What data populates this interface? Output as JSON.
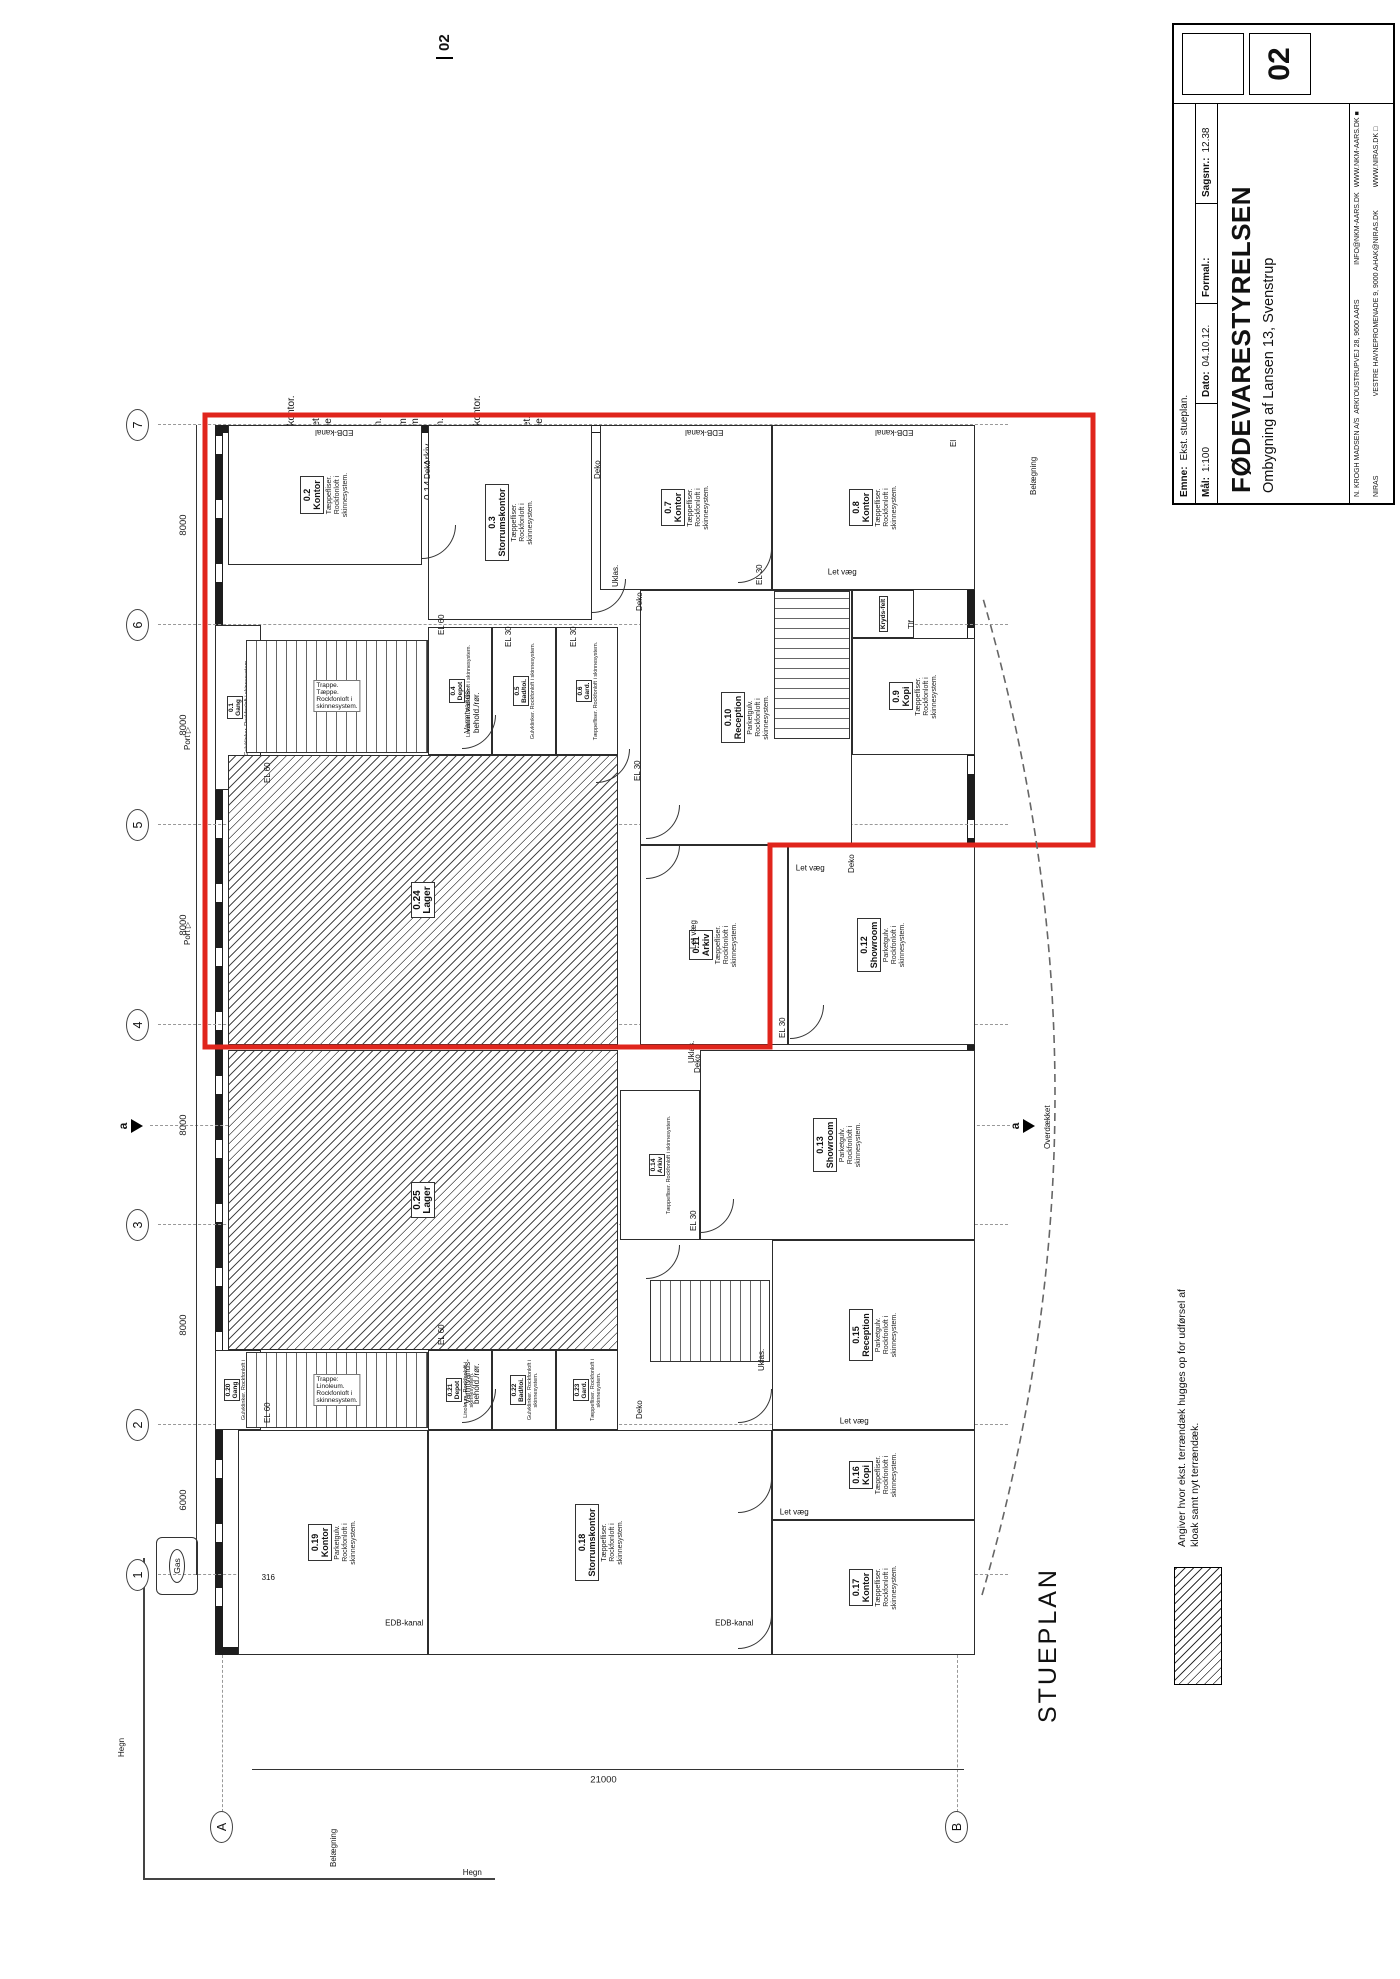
{
  "page": {
    "bg": "#ffffff",
    "accent_red": "#e0251c",
    "sheet_no_top": "02"
  },
  "title_block": {
    "client": "FØDEVARESTYRELSEN",
    "project": "Ombygning af Lansen 13, Svenstrup",
    "emne_label": "Emne:",
    "emne": "Ekst. stueplan.",
    "maal_label": "Mål:",
    "maal": "1:100",
    "dato_label": "Dato:",
    "dato": "04.10.12.",
    "format_label": "Formal.:",
    "format": "",
    "sagsnr_label": "Sagsnr.:",
    "sagsnr": "12.38",
    "drawing_no": "02",
    "firm1_name": "N. KROGH MADSEN A/S",
    "firm1_role": "ARKITEKTER MAA",
    "firm1_addr": "OUSTRUPVEJ 28, 9600 AARS",
    "firm1_email": "INFO@NKM-AARS.DK",
    "firm1_web": "WWW.NKM-AARS.DK",
    "firm1_mark": "■",
    "firm2_name": "NIRAS",
    "firm2_addr": "VESTRE HAVNEPROMENADE 9, 9000 AALBORG",
    "firm2_email": "HAK@NIRAS.DK",
    "firm2_web": "WWW.NIRAS.DK",
    "firm2_mark": "□"
  },
  "room_list": {
    "title": "Rumoversigt:",
    "items": [
      {
        "no": "0.1.",
        "name": "Gang."
      },
      {
        "no": "0.2.",
        "name": "Kontor."
      },
      {
        "no": "0.3.",
        "name": "Storrumskontor."
      },
      {
        "no": "0.4.",
        "name": "Depot."
      },
      {
        "no": "0.5.",
        "name": "Bad - toilet."
      },
      {
        "no": "0.6.",
        "name": "Garderobe."
      },
      {
        "no": "0.7.",
        "name": "Kontor."
      },
      {
        "no": "0.8.",
        "name": "Kontor."
      },
      {
        "no": "0.9.",
        "name": "Kopirum."
      },
      {
        "no": "0.10.",
        "name": "Reception."
      },
      {
        "no": "0.11.",
        "name": "Arkiv."
      },
      {
        "no": "0.12.",
        "name": "Showroom."
      },
      {
        "no": "0.13.",
        "name": "Showroom."
      },
      {
        "no": "0.14.",
        "name": "Arkiv."
      },
      {
        "no": "0.15.",
        "name": "Reception."
      },
      {
        "no": "0.16.",
        "name": "Kopirum."
      },
      {
        "no": "0.17.",
        "name": "Kontor."
      },
      {
        "no": "0.18.",
        "name": "Storrumskontor."
      },
      {
        "no": "0.19.",
        "name": "Kontor."
      },
      {
        "no": "0.20.",
        "name": "Gang."
      },
      {
        "no": "0.21.",
        "name": "Depot."
      },
      {
        "no": "0.22.",
        "name": "Bad / toilet."
      },
      {
        "no": "0.23.",
        "name": "Garderobe."
      },
      {
        "no": "0.24.",
        "name": "Lager."
      },
      {
        "no": "0.25.",
        "name": "Lager."
      }
    ]
  },
  "plan": {
    "label": "STUEPLAN",
    "section_label": "a",
    "legend_text": "Angiver hvor ekst. terrændæk hugges op for udførsel af kloak samt nyt terrændæk.",
    "dim_ab": "21000",
    "grid_cols": [
      {
        "no": "1",
        "x": 404
      },
      {
        "no": "2",
        "x": 554
      },
      {
        "no": "3",
        "x": 754
      },
      {
        "no": "4",
        "x": 954
      },
      {
        "no": "5",
        "x": 1154
      },
      {
        "no": "6",
        "x": 1354
      },
      {
        "no": "7",
        "x": 1554
      }
    ],
    "grid_dims": [
      {
        "t": "6000",
        "x": 479
      },
      {
        "t": "8000",
        "x": 654
      },
      {
        "t": "8000",
        "x": 854
      },
      {
        "t": "8000",
        "x": 1054
      },
      {
        "t": "8000",
        "x": 1254
      },
      {
        "t": "8000",
        "x": 1454
      }
    ],
    "grid_rows": [
      {
        "no": "A",
        "y": 250
      },
      {
        "no": "B",
        "y": 985
      }
    ],
    "rooms": [
      {
        "no": "0.1",
        "name": "Gang",
        "floor": "Gulvklinker. Rockfonloft i skinnesystem.",
        "x": 1189,
        "y": 215,
        "w": 165,
        "h": 46,
        "sm": true
      },
      {
        "no": "0.2",
        "name": "Kontor",
        "floor": "Tæppefliser.\nRockfonloft i\nskinnesystem.",
        "x": 1414,
        "y": 228,
        "w": 140,
        "h": 194
      },
      {
        "no": "0.3",
        "name": "Storrumskontor",
        "floor": "Tæppefliser.\nRockfonloft i\nskinnesystem.",
        "x": 1359,
        "y": 428,
        "w": 195,
        "h": 164
      },
      {
        "no": "0.4",
        "name": "Depot",
        "floor": "Linoleum. Rockfonloft i skinnesystem.",
        "x": 1224,
        "y": 428,
        "w": 128,
        "h": 64,
        "sm": true
      },
      {
        "no": "0.5",
        "name": "Bad/toi.",
        "floor": "Gulvklinker. Rockfonloft i skinnesystem.",
        "x": 1224,
        "y": 492,
        "w": 128,
        "h": 64,
        "sm": true
      },
      {
        "no": "0.6",
        "name": "Gard.",
        "floor": "Tæppefliser. Rockfonloft i skinnesystem.",
        "x": 1224,
        "y": 556,
        "w": 128,
        "h": 62,
        "sm": true
      },
      {
        "no": "0.7",
        "name": "Kontor",
        "floor": "Tæppefliser.\nRockfonloft i\nskinnesystem.",
        "x": 1389,
        "y": 600,
        "w": 165,
        "h": 172
      },
      {
        "no": "0.8",
        "name": "Kontor",
        "floor": "Tæppefliser.\nRockfonloft i\nskinnesystem.",
        "x": 1389,
        "y": 772,
        "w": 165,
        "h": 203
      },
      {
        "no": "0.9",
        "name": "Kopi",
        "floor": "Tæppefliser.\nRockfonloft i\nskinnesystem.",
        "x": 1224,
        "y": 852,
        "w": 117,
        "h": 123
      },
      {
        "no": "",
        "name": "Kryds-felt",
        "floor": "",
        "x": 1341,
        "y": 852,
        "w": 48,
        "h": 62,
        "sm": true
      },
      {
        "no": "0.10",
        "name": "Reception",
        "floor": "Parketgulv.\nRockfonloft i\nskinnesystem.",
        "x": 1134,
        "y": 640,
        "w": 255,
        "h": 212
      },
      {
        "no": "0.11",
        "name": "Arkiv",
        "floor": "Tæppefliser.\nRockfonloft i\nskinnesystem.",
        "x": 934,
        "y": 640,
        "w": 200,
        "h": 148
      },
      {
        "no": "0.12",
        "name": "Showroom",
        "floor": "Parketgulv.\nRockfonloft i\nskinnesystem.",
        "x": 934,
        "y": 788,
        "w": 200,
        "h": 187
      },
      {
        "no": "0.13",
        "name": "Showroom",
        "floor": "Parketgulv.\nRockfonloft i\nskinnesystem.",
        "x": 739,
        "y": 700,
        "w": 190,
        "h": 275
      },
      {
        "no": "0.14",
        "name": "Arkiv",
        "floor": "Tæppefliser. Rockfonloft i skinnesystem.",
        "x": 739,
        "y": 620,
        "w": 150,
        "h": 80,
        "sm": true
      },
      {
        "no": "0.15",
        "name": "Reception",
        "floor": "Parketgulv.\nRockfonloft i\nskinnesystem.",
        "x": 549,
        "y": 772,
        "w": 190,
        "h": 203
      },
      {
        "no": "0.16",
        "name": "Kopi",
        "floor": "Tæppefliser.\nRockfonloft i\nskinnesystem.",
        "x": 459,
        "y": 772,
        "w": 90,
        "h": 203
      },
      {
        "no": "0.17",
        "name": "Kontor",
        "floor": "Tæppefliser.\nRockfonloft i\nskinnesystem.",
        "x": 324,
        "y": 772,
        "w": 135,
        "h": 203
      },
      {
        "no": "0.18",
        "name": "Storrumskontor",
        "floor": "Tæppefliser.\nRockfonloft i\nskinnesystem.",
        "x": 324,
        "y": 428,
        "w": 225,
        "h": 344
      },
      {
        "no": "0.19",
        "name": "Kontor",
        "floor": "Parketgulv.\nRockfonloft i\nskinnesystem.",
        "x": 324,
        "y": 238,
        "w": 225,
        "h": 190
      },
      {
        "no": "0.20",
        "name": "Gang",
        "floor": "Gulvklinker. Rockfonloft i skinnesystem.",
        "x": 549,
        "y": 215,
        "w": 80,
        "h": 46,
        "sm": true
      },
      {
        "no": "0.21",
        "name": "Depot",
        "floor": "Linoleum. Rockfonloft i skinnesystem.",
        "x": 549,
        "y": 428,
        "w": 80,
        "h": 64,
        "sm": true
      },
      {
        "no": "0.22",
        "name": "Bad/toi.",
        "floor": "Gulvklinker. Rockfonloft i skinnesystem.",
        "x": 549,
        "y": 492,
        "w": 80,
        "h": 64,
        "sm": true
      },
      {
        "no": "0.23",
        "name": "Gard.",
        "floor": "Tæppefliser. Rockfonloft i skinnesystem.",
        "x": 549,
        "y": 556,
        "w": 80,
        "h": 62,
        "sm": true
      },
      {
        "no": "0.24",
        "name": "Lager",
        "floor": "",
        "x": 934,
        "y": 228,
        "w": 290,
        "h": 390,
        "hatch": true
      },
      {
        "no": "0.25",
        "name": "Lager",
        "floor": "",
        "x": 629,
        "y": 228,
        "w": 300,
        "h": 390,
        "hatch": true
      }
    ],
    "stairs": [
      {
        "x": 1226,
        "y": 246,
        "w": 113,
        "h": 182,
        "o": "v",
        "label": "Trappe.\nTæppe.\nRockfonloft i\nskinnesystem."
      },
      {
        "x": 551,
        "y": 246,
        "w": 76,
        "h": 182,
        "o": "v",
        "label": "Trappe:\nLinoleum.\nRockfonloft i\nskinnesystem."
      },
      {
        "x": 1240,
        "y": 774,
        "w": 148,
        "h": 76,
        "o": "h",
        "label": ""
      },
      {
        "x": 617,
        "y": 650,
        "w": 82,
        "h": 120,
        "o": "v",
        "label": ""
      }
    ],
    "doors": [
      [
        1196,
        596
      ],
      [
        1420,
        422
      ],
      [
        1366,
        592
      ],
      [
        1396,
        738
      ],
      [
        1140,
        646
      ],
      [
        940,
        790
      ],
      [
        746,
        700
      ],
      [
        556,
        738
      ],
      [
        466,
        738
      ],
      [
        330,
        738
      ],
      [
        556,
        462
      ],
      [
        1230,
        462
      ],
      [
        1100,
        646
      ],
      [
        700,
        646
      ]
    ],
    "small_labels": [
      {
        "t": "EDB-kanal",
        "x": 1528,
        "y": 330,
        "r": -90
      },
      {
        "t": "EDB-kanal",
        "x": 1528,
        "y": 700,
        "r": -90
      },
      {
        "t": "EDB-kanal",
        "x": 1528,
        "y": 890,
        "r": -90
      },
      {
        "t": "EDB-kanal",
        "x": 336,
        "y": 400,
        "r": 90
      },
      {
        "t": "EDB-kanal",
        "x": 336,
        "y": 730,
        "r": 90
      },
      {
        "t": "Deko",
        "x": 1500,
        "y": 424,
        "r": 0
      },
      {
        "t": "Deko",
        "x": 1500,
        "y": 594,
        "r": 0
      },
      {
        "t": "Deko",
        "x": 1368,
        "y": 636,
        "r": 0
      },
      {
        "t": "Deko",
        "x": 1106,
        "y": 848,
        "r": 0
      },
      {
        "t": "Deko",
        "x": 906,
        "y": 694,
        "r": 0
      },
      {
        "t": "Deko",
        "x": 560,
        "y": 636,
        "r": 0
      },
      {
        "t": "Let væg",
        "x": 1096,
        "y": 806,
        "r": 90
      },
      {
        "t": "Let væg",
        "x": 1392,
        "y": 838,
        "r": 90
      },
      {
        "t": "Let væg",
        "x": 543,
        "y": 850,
        "r": 90
      },
      {
        "t": "Let væg",
        "x": 452,
        "y": 790,
        "r": 90
      },
      {
        "t": "Let væg",
        "x": 1030,
        "y": 690,
        "r": 0
      },
      {
        "t": "EL 30",
        "x": 1198,
        "y": 634,
        "r": 0
      },
      {
        "t": "EL 30",
        "x": 1332,
        "y": 505,
        "r": 0
      },
      {
        "t": "EL 30",
        "x": 1332,
        "y": 570,
        "r": 0
      },
      {
        "t": "EL 30",
        "x": 1394,
        "y": 756,
        "r": 0
      },
      {
        "t": "EL 30",
        "x": 941,
        "y": 779,
        "r": 0
      },
      {
        "t": "EL 30",
        "x": 748,
        "y": 690,
        "r": 0
      },
      {
        "t": "EL 60",
        "x": 1196,
        "y": 264,
        "r": 0
      },
      {
        "t": "EL 60",
        "x": 1344,
        "y": 438,
        "r": 0
      },
      {
        "t": "EL 60",
        "x": 556,
        "y": 264,
        "r": 0
      },
      {
        "t": "EL 60",
        "x": 634,
        "y": 438,
        "r": 0
      },
      {
        "t": "Uklas.",
        "x": 1392,
        "y": 612,
        "r": 0
      },
      {
        "t": "Uklas.",
        "x": 916,
        "y": 688,
        "r": 0
      },
      {
        "t": "Uklas.",
        "x": 608,
        "y": 758,
        "r": 0
      },
      {
        "t": "Tlf",
        "x": 1350,
        "y": 908,
        "r": 0
      },
      {
        "t": "El",
        "x": 1532,
        "y": 950,
        "r": 0
      },
      {
        "t": "Varmtvands-\nbehold./rør.",
        "x": 1246,
        "y": 464,
        "r": 0
      },
      {
        "t": "Varmtvands-\nbehold./rør.",
        "x": 575,
        "y": 464,
        "r": 0
      },
      {
        "t": "Belægning",
        "x": 1484,
        "y": 1030,
        "r": 0
      },
      {
        "t": "Belægning",
        "x": 112,
        "y": 330,
        "r": 0
      },
      {
        "t": "Hegn",
        "x": 222,
        "y": 118,
        "r": 0
      },
      {
        "t": "Hegn",
        "x": 96,
        "y": 468,
        "r": 90
      },
      {
        "t": "Overdækket",
        "x": 830,
        "y": 1044,
        "r": 0
      },
      {
        "t": "Port ▷",
        "x": 1034,
        "y": 184,
        "r": 0
      },
      {
        "t": "Port ▷",
        "x": 1229,
        "y": 184,
        "r": 0
      },
      {
        "t": "316",
        "x": 394,
        "y": 264,
        "r": 90
      }
    ]
  }
}
